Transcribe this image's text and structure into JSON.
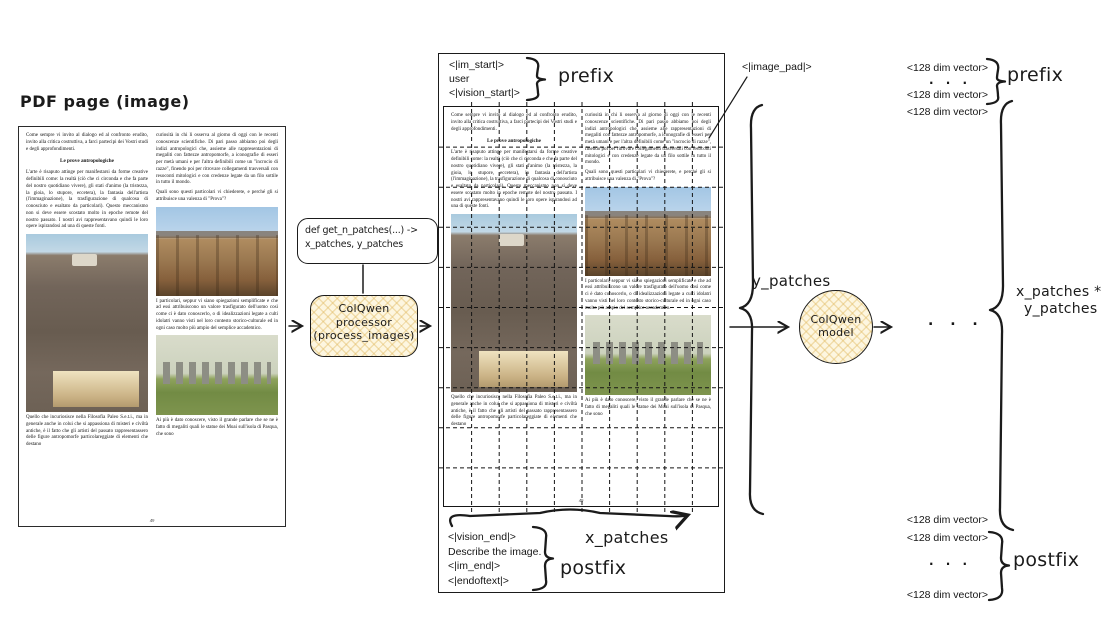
{
  "diagram": {
    "pdf_page_caption": "PDF page (image)",
    "function_box": {
      "line1": "def get_n_patches(...) ->",
      "line2": "x_patches, y_patches"
    },
    "processor_node": {
      "line1": "ColQwen",
      "line2": "processor",
      "line3": "(process_images)"
    },
    "model_node": {
      "line1": "ColQwen",
      "line2": "model"
    },
    "prefix_tokens": {
      "t1": "<|im_start|>",
      "t2": "user",
      "t3": "<|vision_start|>"
    },
    "postfix_tokens": {
      "t1": "<|vision_end|>",
      "t2": "Describe the image.",
      "t3": "<|im_end|>",
      "t4": "<|endoftext|>"
    },
    "image_pad_token": "<|image_pad|>",
    "prefix_label": "prefix",
    "postfix_label": "postfix",
    "x_patches_label": "x_patches",
    "y_patches_label": "y_patches",
    "patches_product_label": {
      "line1": "x_patches *",
      "line2": "y_patches"
    },
    "vector_token": "<128 dim vector>",
    "ellipsis": ". . .",
    "grid": {
      "x_patches_shown": 10,
      "y_patches_shown": 10
    },
    "colors": {
      "hatch_fill": "#fdf6e0",
      "hatch_line": "#eed9a0",
      "stroke": "#1b1b1b",
      "grid_line": "#141414"
    }
  },
  "pdf_page": {
    "page_number": "49",
    "left_column": [
      {
        "type": "para",
        "text": "Come sempre vi invito al dialogo ed al confronto erudito, invito alla critica costruttiva, a farci partecipi dei Vostri studi e degli approfondimenti."
      },
      {
        "type": "heading",
        "text": "Le prove antropologiche"
      },
      {
        "type": "para",
        "text": "L'arte è risaputo attinge per manifestarsi da forme creative definibili come: la realtà (ciò che ci circonda e che fa parte del nostro quotidiano vivere), gli stati d'animo (la tristezza, la gioia, lo stupore, eccetera), la fantasia dell'artista (l'immaginazione), la trasfigurazione di qualcosa di conosciuto e esaltato da particolari). Questo meccanismo non si deve essere scostato molto in epoche remote del nostro passato. I nostri avi rappresentavano quindi le loro opere ispirandosi ad una di queste fonti."
      },
      {
        "type": "photo",
        "id": "gateway",
        "name": "stone-carving-photo"
      },
      {
        "type": "para",
        "text": "Quello che incuriosisce nella Filosofia Paleo S.e.t.i., ma in generale anche in colui che si appassiona di misteri e civiltà antiche, è il fatto che gli artisti del passato rappresentassero delle figure antropomorfe particolareggiate di elementi che destano"
      }
    ],
    "right_column": [
      {
        "type": "para",
        "text": "curiosità in chi li osserva al giorno di oggi con le recenti conoscenze scientifiche. Di pari passo abbiamo poi degli indizi antropologici che, assieme alle rappresentazioni di megaliti con fattezze antropomorfe, a iconografie di esseri per metà umani e per l'altra definibili come un \"incrocio di razze\", finendo poi per ritrovare collegamenti trasversali con resoconti mitologici e con credenze legate da un filo sottile in tutto il mondo."
      },
      {
        "type": "para",
        "text": "Quali sono questi particolari vi chiederete, e perché gli si attribuisce una valenza di \"Prova\"?"
      },
      {
        "type": "photo",
        "id": "luxor",
        "name": "temple-columns-photo"
      },
      {
        "type": "para",
        "text": "I particolari, seppur vi siano spiegazioni semplificate e che ad essi attribuiscono un valore trasfigurato dell'uomo così come ci è dato conoscerlo, o di idealizzazioni legate a culti idolatri vanno visti nel loro contesto storico-culturale ed in ogni caso molto più ampio del semplice accademico."
      },
      {
        "type": "photo",
        "id": "stonehenge",
        "name": "stonehenge-photo"
      },
      {
        "type": "para",
        "text": "Ai più è dato conoscere, visto il grande parlare che se ne è fatto di megaliti quali le statue dei Moai sull'isola di Pasqua, che sono"
      }
    ]
  }
}
